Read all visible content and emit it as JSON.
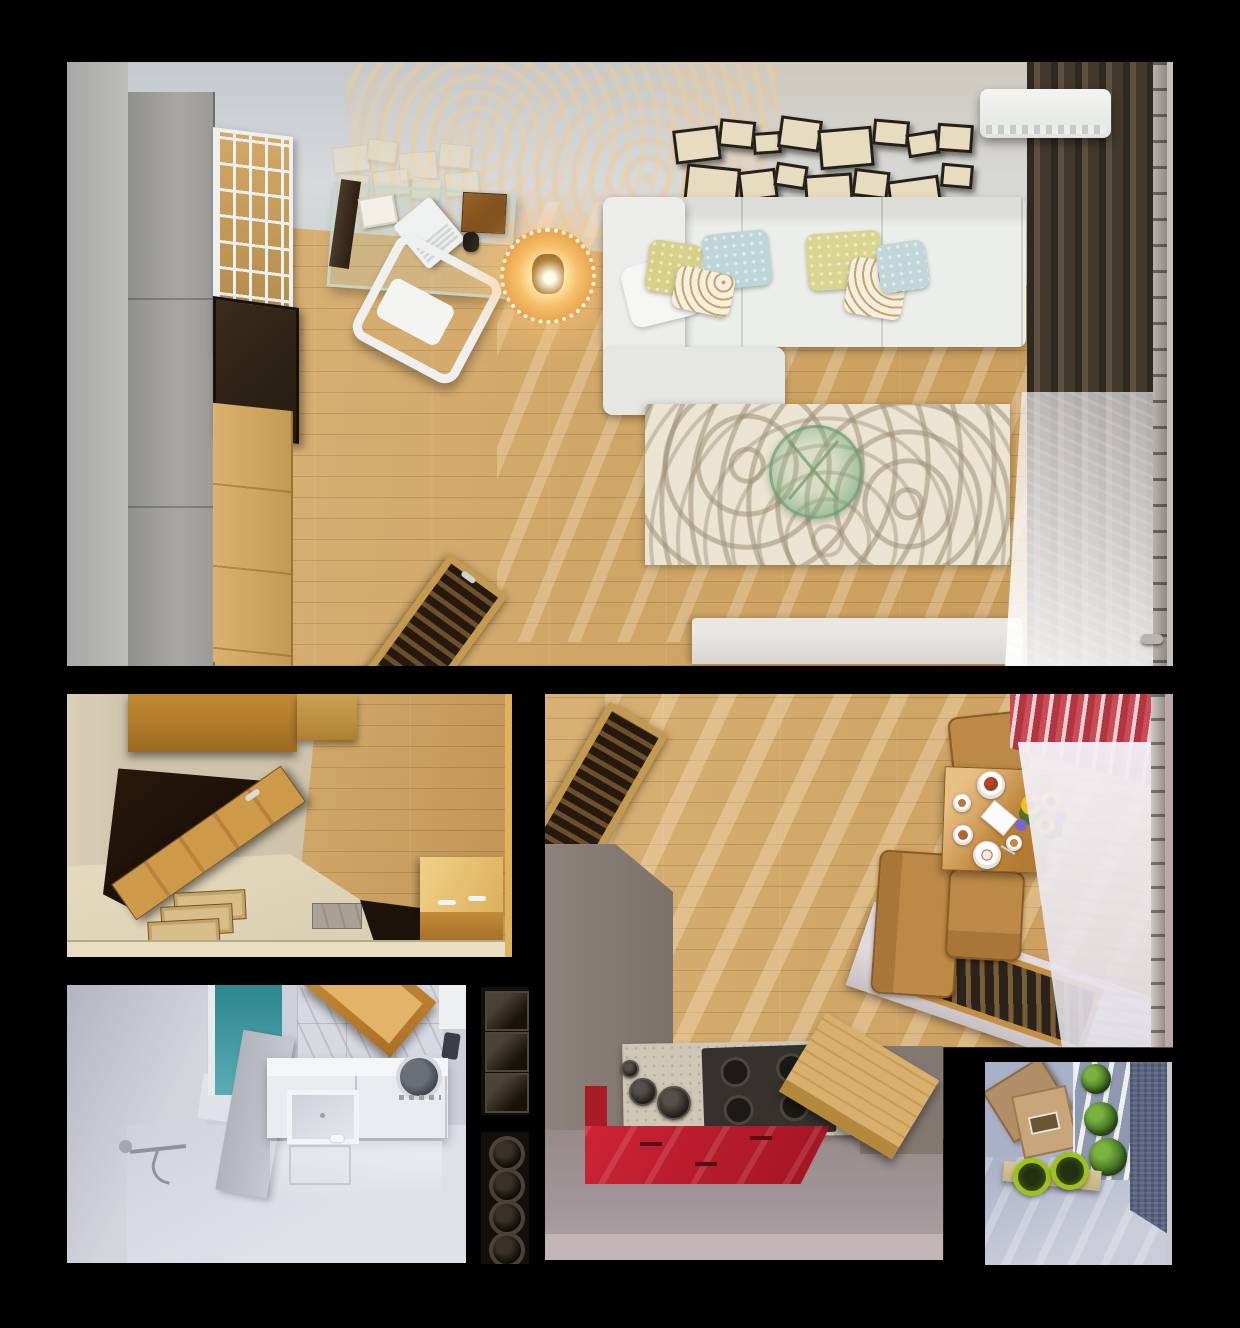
{
  "meta": {
    "title": "Overhead 3D render of a small apartment interior",
    "view": "top-down cutaway floor plan render",
    "canvas_w": 1240,
    "canvas_h": 1328,
    "background": "#000000"
  },
  "palette": {
    "floor_wood": "#d0a462",
    "wall_gray": "#c6cbce",
    "sofa_white": "#eceeea",
    "curtain_dark_brown": "#473c30",
    "kitchen_red": "#c12030",
    "curtain_stripe_red": "#cc4b59",
    "bathroom_pale": "#ccd0da",
    "shower_teal": "#3f8f96",
    "balcony_blue": "#aab0c6",
    "plant_green": "#3f6b24",
    "pot_lime": "#9ec11e",
    "rug_cream": "#ebe4d2",
    "furniture_wood": "#c89040"
  },
  "rooms": [
    {
      "id": "living-room",
      "label": "Living room",
      "objects": [
        "gray wardrobe",
        "cube bookshelf",
        "glass desk",
        "laptop",
        "white chair",
        "glowing lace lamp table",
        "white sectional sofa",
        "throw pillows",
        "patterned rug",
        "green glass coffee table",
        "white media bench",
        "wooden ladder rack",
        "picture frame collage",
        "air conditioner",
        "dark drapes",
        "sheer curtain",
        "curtain rod"
      ]
    },
    {
      "id": "hallway",
      "label": "Hallway entry",
      "objects": [
        "wall cabinet",
        "open wooden door",
        "dark doorway",
        "door mats",
        "stone step",
        "wooden chest"
      ]
    },
    {
      "id": "bathroom",
      "label": "Bathroom",
      "objects": [
        "teal shower glass",
        "partition wall",
        "marble tile wall",
        "open wooden door",
        "vanity with sink",
        "washing machine",
        "shower fixture",
        "reflective floor"
      ]
    },
    {
      "id": "kitchen",
      "label": "Kitchen and dining",
      "objects": [
        "floor hatch bench",
        "gray wall",
        "travertine counter",
        "gas cooktop",
        "pots",
        "red cabinet fronts",
        "wooden bench",
        "dining table",
        "plates of food",
        "sunflower bouquet",
        "wooden chairs",
        "red striped curtain",
        "sheer curtain",
        "curtain rod",
        "balcony sill window"
      ]
    },
    {
      "id": "balcony",
      "label": "Balcony",
      "objects": [
        "wooden crate",
        "window plants",
        "textured curtain",
        "planter bench",
        "lime grass pots"
      ]
    },
    {
      "id": "wall-rack",
      "label": "Niche rack column",
      "objects": [
        "three square niches",
        "four round niches"
      ]
    }
  ]
}
